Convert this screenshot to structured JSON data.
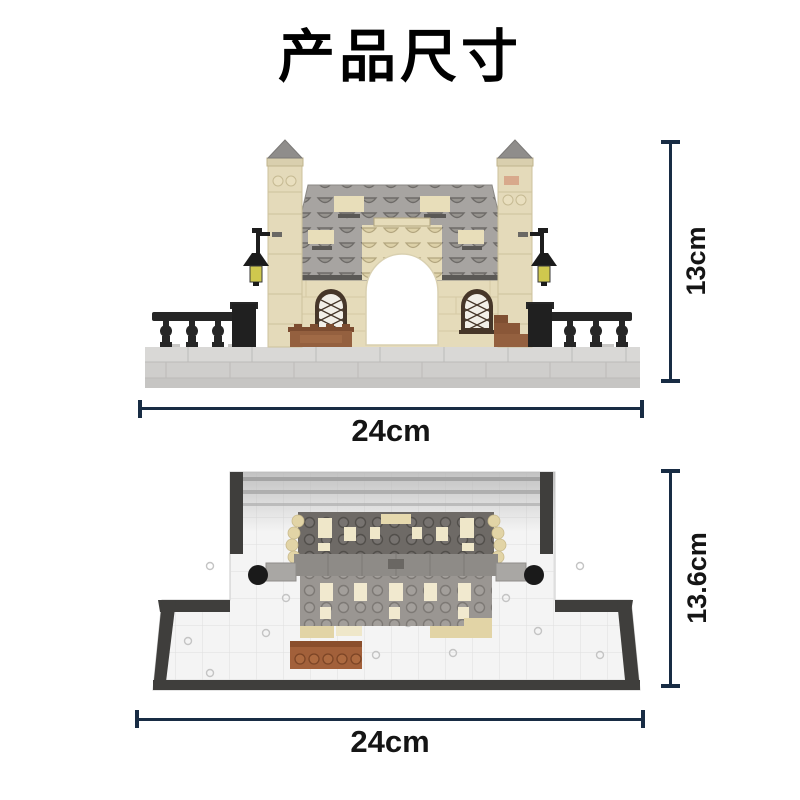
{
  "title": "产品尺寸",
  "front_view": {
    "height_label": "13cm",
    "width_label": "24cm"
  },
  "top_view": {
    "depth_label": "13.6cm",
    "width_label": "24cm"
  },
  "colors": {
    "dimension_line": "#182c44",
    "label_text": "#151515",
    "background": "#ffffff",
    "brick_tan": "#e5dbba",
    "roof_gray": "#a7a4a1",
    "railing_black": "#262626",
    "planter_brown": "#94603f",
    "baseplate_gray": "#d9d8d6"
  }
}
